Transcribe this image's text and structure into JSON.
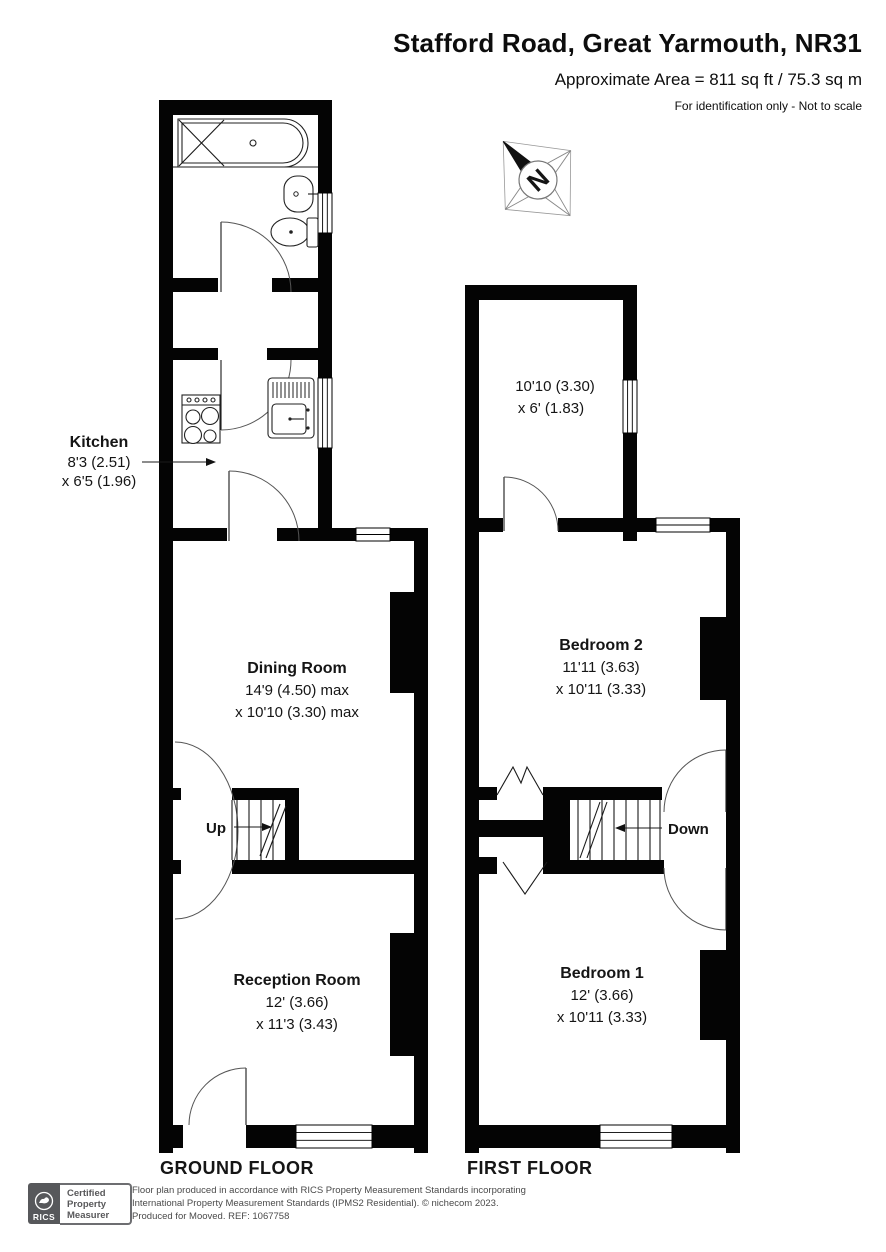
{
  "header": {
    "title": "Stafford Road, Great Yarmouth, NR31",
    "area": "Approximate Area = 811 sq ft / 75.3 sq m",
    "note": "For identification only - Not to scale"
  },
  "compass": {
    "label": "N"
  },
  "floors": {
    "ground": {
      "label": "GROUND FLOOR",
      "stairs_label": "Up",
      "rooms": {
        "kitchen": {
          "name": "Kitchen",
          "dim1": "8'3 (2.51)",
          "dim2": "x 6'5 (1.96)"
        },
        "dining": {
          "name": "Dining Room",
          "dim1": "14'9 (4.50) max",
          "dim2": "x 10'10 (3.30) max"
        },
        "reception": {
          "name": "Reception Room",
          "dim1": "12' (3.66)",
          "dim2": "x 11'3 (3.43)"
        }
      }
    },
    "first": {
      "label": "FIRST FLOOR",
      "stairs_label": "Down",
      "rooms": {
        "top_room": {
          "dim1": "10'10 (3.30)",
          "dim2": "x 6' (1.83)"
        },
        "bedroom2": {
          "name": "Bedroom 2",
          "dim1": "11'11 (3.63)",
          "dim2": "x 10'11 (3.33)"
        },
        "bedroom1": {
          "name": "Bedroom 1",
          "dim1": "12' (3.66)",
          "dim2": "x 10'11 (3.33)"
        }
      }
    }
  },
  "footer": {
    "badge": {
      "brand": "RICS",
      "line1": "Certified",
      "line2": "Property",
      "line3": "Measurer"
    },
    "disclaimer_line1": "Floor plan produced in accordance with RICS Property Measurement Standards incorporating",
    "disclaimer_line2": "International Property Measurement Standards (IPMS2 Residential).   © nichecom 2023.",
    "disclaimer_line3": "Produced for Mooved.   REF: 1067758",
    "colors": {
      "badge_gray": "#57585b"
    }
  }
}
